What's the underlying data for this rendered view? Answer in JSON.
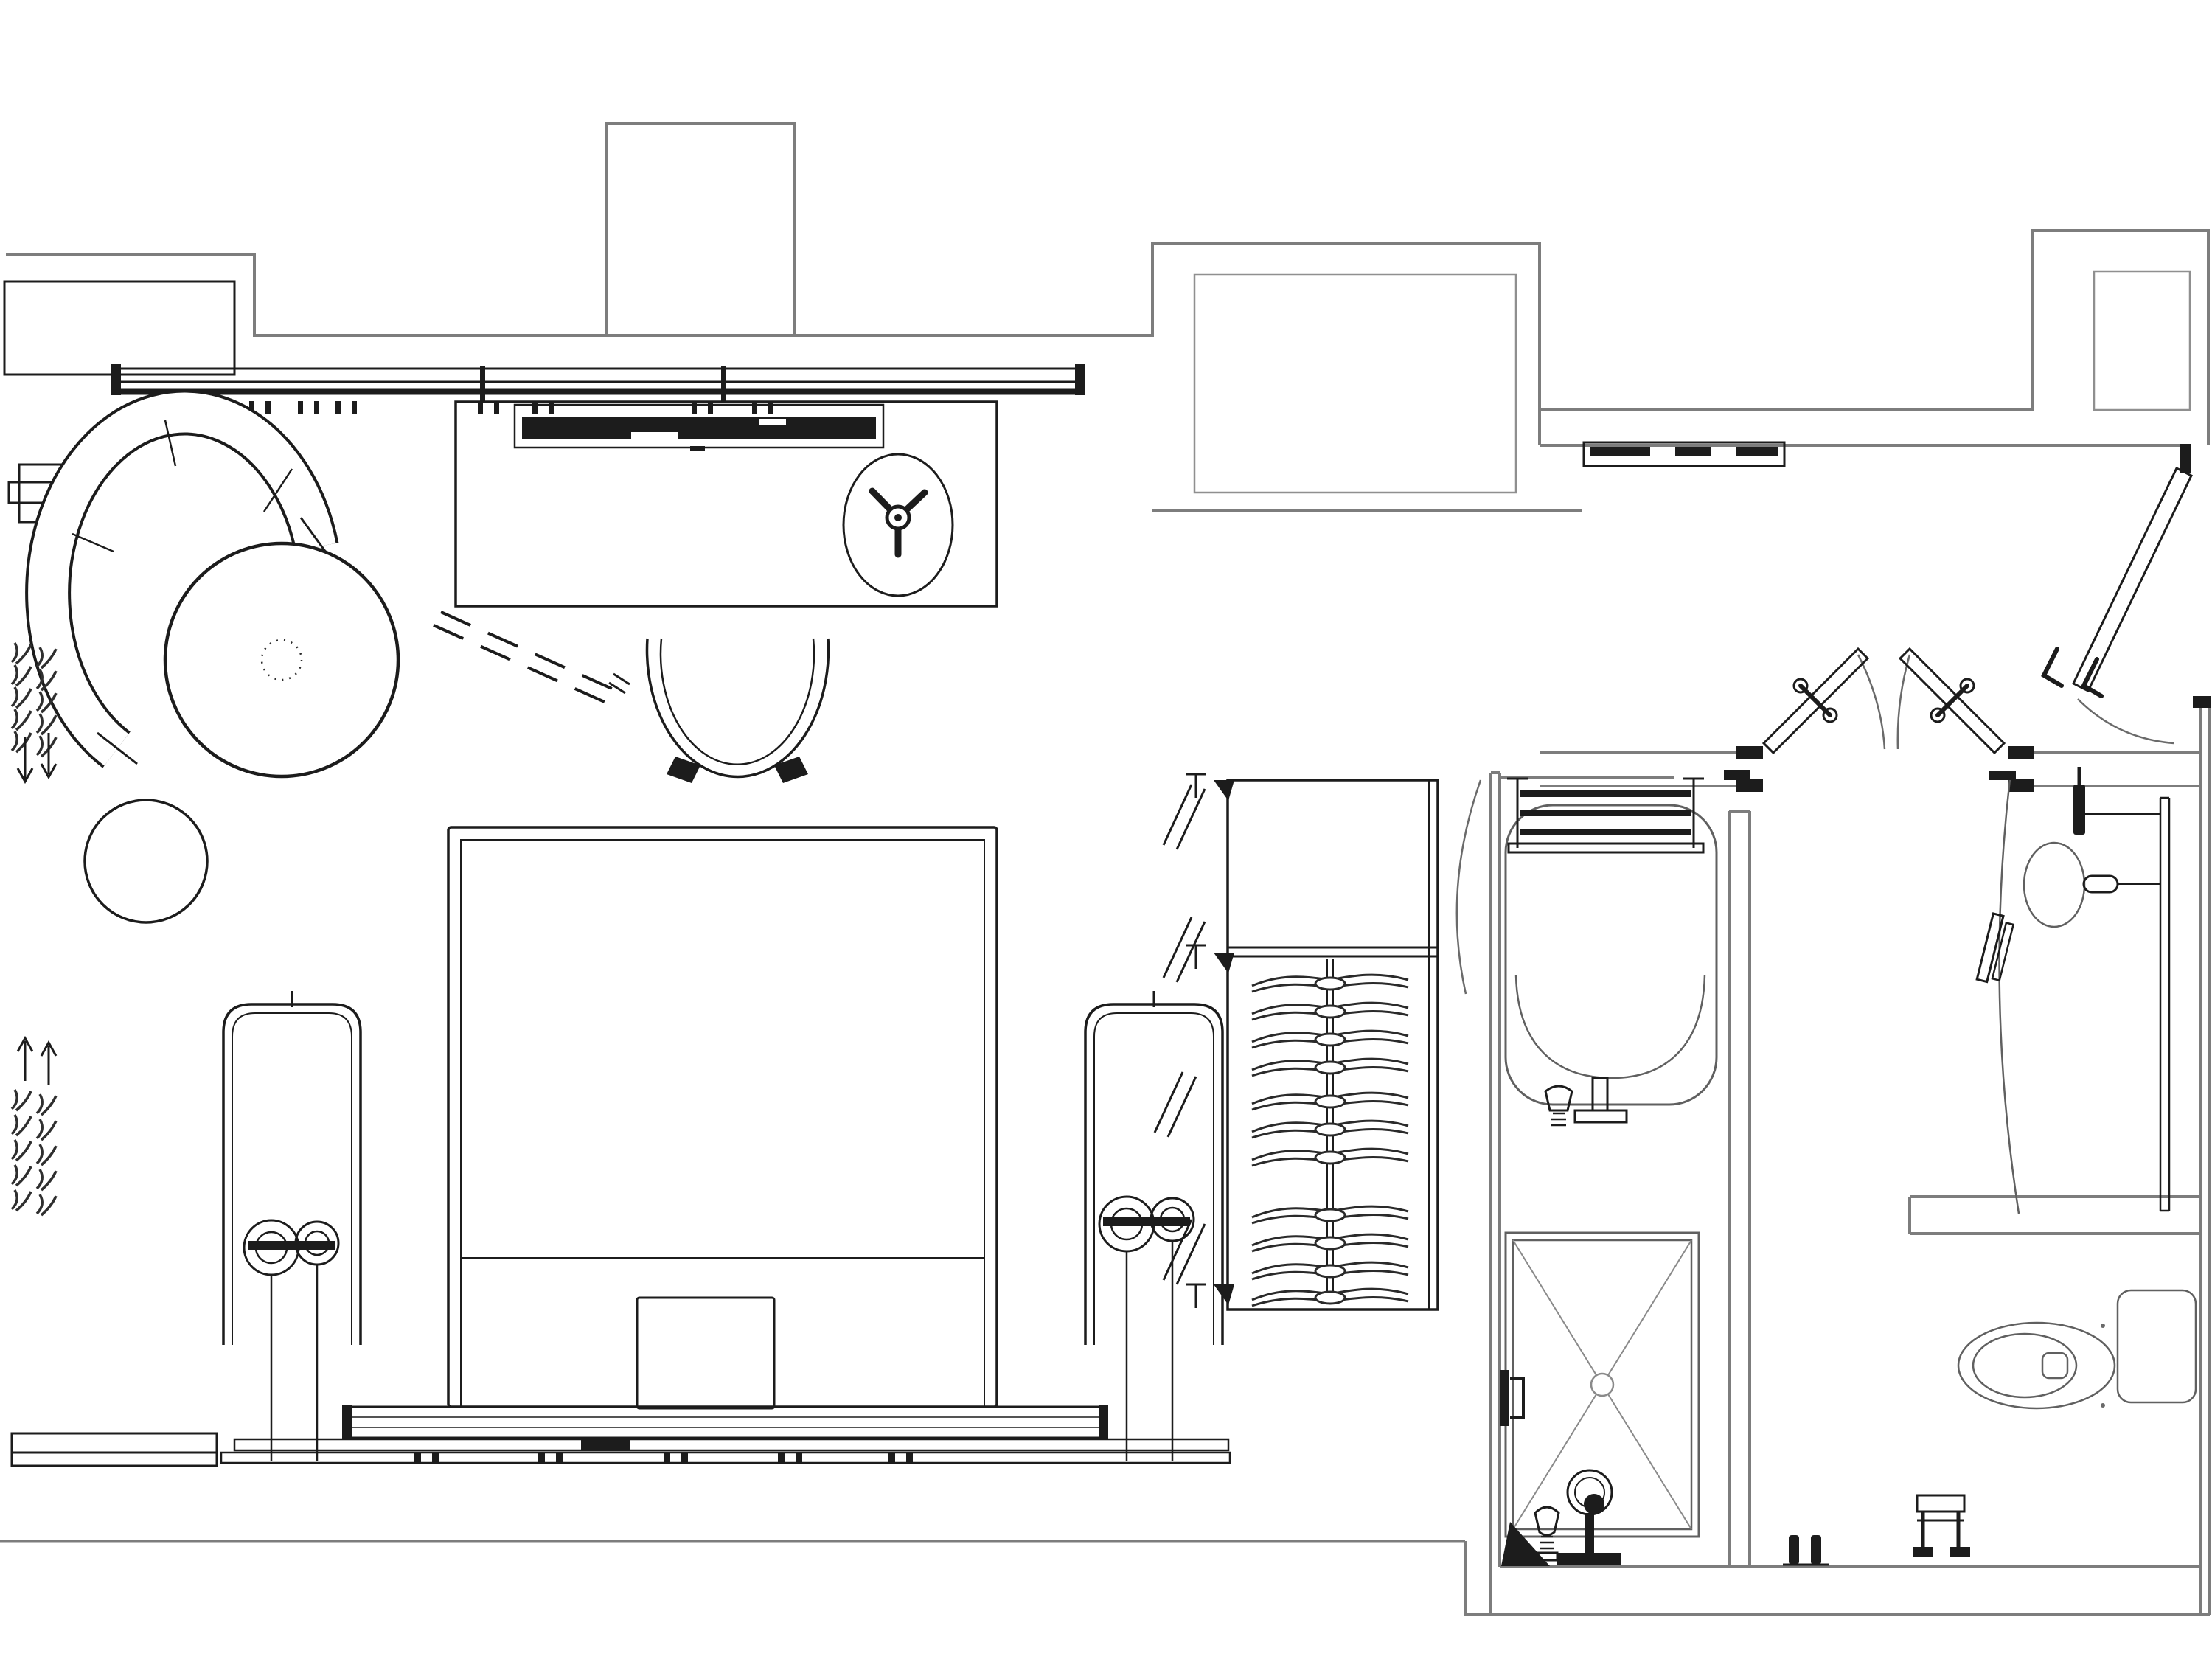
{
  "meta": {
    "title": "Hotel guest room floor plan",
    "drawing_type": "architectural floor plan, top view, black line work on white"
  },
  "colors": {
    "background": "#ffffff",
    "wall": "#7d7d7d",
    "wall_light": "#8f8f8f",
    "ink": "#1c1c1c",
    "fixture": "#606060"
  },
  "legend": {
    "spaces": [
      "bedroom / living area",
      "window wall",
      "entry vestibule",
      "closet",
      "tub & shower room",
      "vanity area",
      "toilet area"
    ],
    "furniture": [
      "curved sofa",
      "round ottoman table",
      "round stool",
      "side table",
      "desk / media console",
      "wall TV",
      "fan symbol",
      "desk chair",
      "folding rack (dashed)",
      "king bed",
      "nightstand x2",
      "twin table lamps x2",
      "bench",
      "wardrobe rod with 11 hangers",
      "bifold closet doors",
      "double doors",
      "entry door",
      "art / console bar"
    ],
    "bath_fixtures": [
      "bathtub",
      "towel ladder rack",
      "tub filler + spout",
      "walk-in shower with X pan",
      "shower head",
      "shower mixer",
      "shower door handle",
      "vanity counter (curved)",
      "oval basin",
      "wall faucet",
      "mirror strip",
      "wall sconce",
      "towel rail",
      "toilet with tank",
      "toilet paper stand",
      "robe hooks"
    ],
    "window_symbols": [
      "curtain squiggle group with down arrows",
      "curtain squiggle group with up arrows",
      "mullion ticks"
    ]
  },
  "repeats": {
    "hangers": {
      "template": "#tpl-hanger",
      "item_name": "clothes-hanger",
      "positions": [
        [
          1804,
          1332
        ],
        [
          1804,
          1370
        ],
        [
          1804,
          1408
        ],
        [
          1804,
          1446
        ],
        [
          1804,
          1492
        ],
        [
          1804,
          1530
        ],
        [
          1804,
          1568
        ],
        [
          1804,
          1646
        ],
        [
          1804,
          1684
        ],
        [
          1804,
          1722
        ],
        [
          1804,
          1758
        ]
      ]
    },
    "curtain_squiggles_top": {
      "template": "#tpl-squiggle",
      "item_name": "curtain-squiggle",
      "positions": [
        [
          14,
          872
        ],
        [
          14,
          902
        ],
        [
          14,
          932
        ],
        [
          14,
          962
        ],
        [
          14,
          992
        ],
        [
          48,
          878
        ],
        [
          48,
          908
        ],
        [
          48,
          938
        ],
        [
          48,
          968
        ],
        [
          48,
          998
        ]
      ]
    },
    "curtain_squiggles_bottom": {
      "template": "#tpl-squiggle",
      "item_name": "curtain-squiggle",
      "positions": [
        [
          14,
          1478
        ],
        [
          14,
          1512
        ],
        [
          14,
          1546
        ],
        [
          14,
          1580
        ],
        [
          14,
          1614
        ],
        [
          48,
          1484
        ],
        [
          48,
          1518
        ],
        [
          48,
          1552
        ],
        [
          48,
          1586
        ],
        [
          48,
          1620
        ]
      ]
    },
    "window_ticks": {
      "template": "#tpl-tickpair",
      "item_name": "mullion-tick-pair",
      "positions": [
        [
          200,
          544
        ],
        [
          280,
          544
        ],
        [
          338,
          544
        ],
        [
          404,
          544
        ],
        [
          455,
          544
        ],
        [
          648,
          544
        ],
        [
          722,
          544
        ],
        [
          938,
          544
        ],
        [
          1020,
          544
        ]
      ]
    },
    "bed_feet": {
      "template": "#tpl-foot",
      "item_name": "bed-foot-tick",
      "positions": [
        [
          562,
          1970
        ],
        [
          730,
          1970
        ],
        [
          900,
          1970
        ],
        [
          1055,
          1970
        ],
        [
          1205,
          1970
        ]
      ]
    }
  }
}
